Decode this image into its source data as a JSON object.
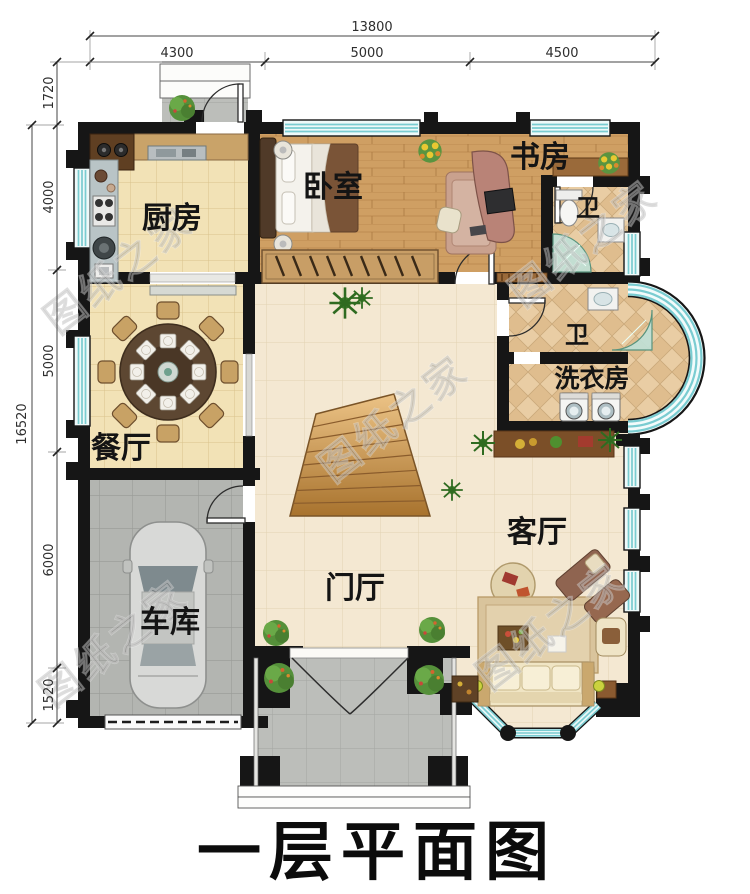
{
  "page_title": "一层平面图",
  "watermark_text": "图纸之家",
  "dimensions": {
    "top_total": "13800",
    "top_segments": [
      "4300",
      "5000",
      "4500"
    ],
    "left_total": "16520",
    "left_segments": [
      "1720",
      "4000",
      "5000",
      "6000",
      "1520"
    ]
  },
  "rooms": {
    "kitchen": "厨房",
    "bedroom": "卧室",
    "study": "书房",
    "bath_top": "卫",
    "bath_mid": "卫",
    "laundry": "洗衣房",
    "dining": "餐厅",
    "living": "客厅",
    "foyer": "门厅",
    "garage": "车库"
  },
  "colors": {
    "wall": "#161616",
    "window_teal": "#7accd1",
    "floor_tile_cream": "#f2e2b6",
    "floor_wood": "#cf9f63",
    "floor_pale": "#f4e8d2",
    "floor_garage": "#b3b5b1",
    "floor_bath": "#e9cda4",
    "floor_porch": "#bcbeba",
    "watermark": "#5a5a5a"
  }
}
